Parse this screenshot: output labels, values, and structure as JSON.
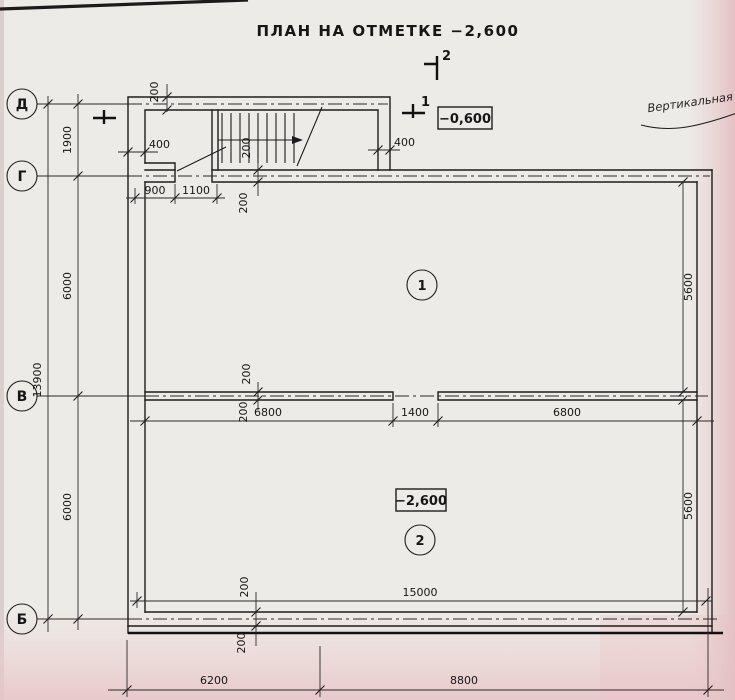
{
  "page": {
    "title": "ПЛАН НА ОТМЕТКЕ −2,600"
  },
  "axes": {
    "d": "Д",
    "g": "Г",
    "v": "В",
    "b": "Б"
  },
  "rooms": {
    "r1": "1",
    "r2": "2",
    "r2_elevation": "−2,600"
  },
  "sections": {
    "s1": "1",
    "s2": "2",
    "elevation_top": "−0,600"
  },
  "note": {
    "text": "Вертикальная ги"
  },
  "dims": {
    "d1900": "1900",
    "d6000a": "6000",
    "d6000b": "6000",
    "d13900": "13900",
    "d200top": "200",
    "d400l": "400",
    "d400r": "400",
    "d900": "900",
    "d1100": "1100",
    "g200a": "200",
    "g200b": "200",
    "v200a": "200",
    "v200b": "200",
    "b200a": "200",
    "b200b": "200",
    "d6800l": "6800",
    "d1400": "1400",
    "d6800r": "6800",
    "d5600u": "5600",
    "d5600l": "5600",
    "d15000i": "15000",
    "d6200": "6200",
    "d8800": "8800",
    "d15000b": "15000"
  }
}
